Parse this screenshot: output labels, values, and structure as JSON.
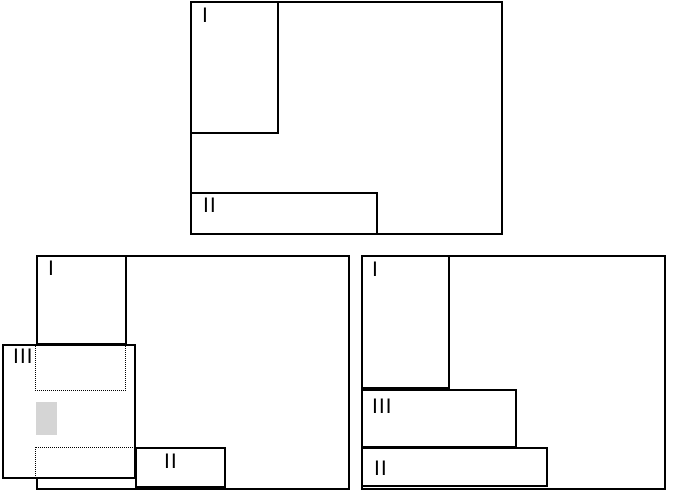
{
  "figure": {
    "description": "Three schematic window-layout panels with nested labeled regions",
    "colors": {
      "line": "#000000",
      "background": "#ffffff",
      "highlight_swatch": "#d5d5d5"
    },
    "panels": [
      {
        "id": "top",
        "regions": [
          {
            "label": "I"
          },
          {
            "label": "II"
          }
        ]
      },
      {
        "id": "bottom-left",
        "regions": [
          {
            "label": "I"
          },
          {
            "label": "III"
          },
          {
            "label": "II"
          }
        ],
        "extras": [
          {
            "type": "dotted-outline",
            "position": "upper"
          },
          {
            "type": "highlight-swatch"
          },
          {
            "type": "dotted-outline",
            "position": "lower"
          }
        ]
      },
      {
        "id": "bottom-right",
        "regions": [
          {
            "label": "I"
          },
          {
            "label": "III"
          },
          {
            "label": "II"
          }
        ]
      }
    ]
  }
}
